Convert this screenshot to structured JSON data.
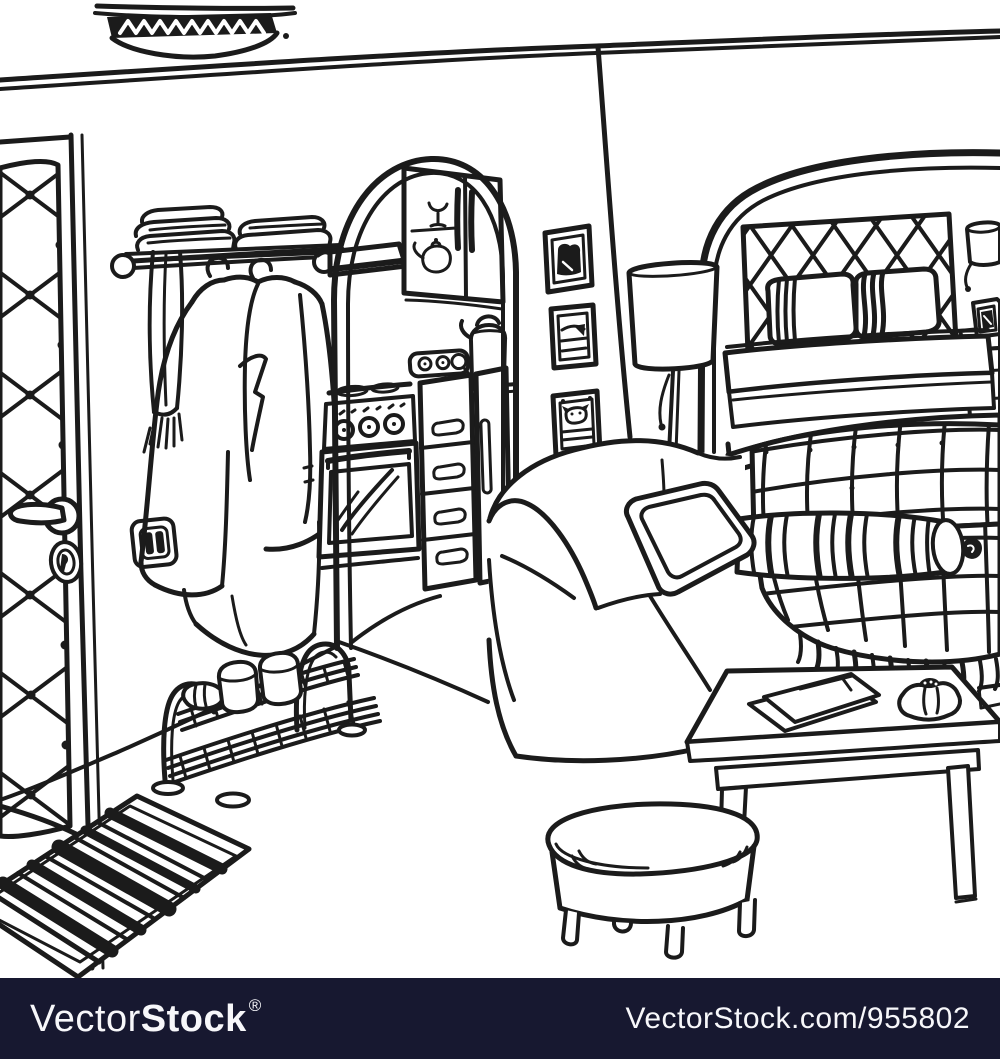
{
  "artwork": {
    "description": "Black ink hand-drawn sketch of a studio apartment interior",
    "ink_color": "#1b1b1b",
    "background_color": "#ffffff",
    "objects": [
      "ceiling lamp",
      "padded front door",
      "door handle",
      "keyhole",
      "light switch",
      "wall shelf with folded linens",
      "coat rail",
      "hanging coats",
      "fringed scarf",
      "kitchen archway",
      "extractor hood",
      "glass wall cabinet",
      "goblet",
      "teapot",
      "power outlet with plug",
      "electric kettle",
      "cooker with oven",
      "drawer cabinet",
      "tall cupboard",
      "three wall pictures",
      "floor lamp",
      "bedroom alcove",
      "lattice headboard",
      "striped pillows",
      "bed",
      "wall sconce",
      "bedside photo frame",
      "nightstand",
      "sofa",
      "throw pillow",
      "striped bolster cushion",
      "checked plaid blanket with fringe",
      "coffee table",
      "papers",
      "small garlic ornament",
      "round ottoman",
      "metal shoe rack",
      "slipper",
      "striped rug"
    ]
  },
  "watermark": {
    "bar_color": "#171830",
    "text_color": "#f7f7fa",
    "brand_prefix": "Vector",
    "brand_suffix": "Stock",
    "registered_mark": "®",
    "credit_url": "VectorStock.com/955802"
  }
}
